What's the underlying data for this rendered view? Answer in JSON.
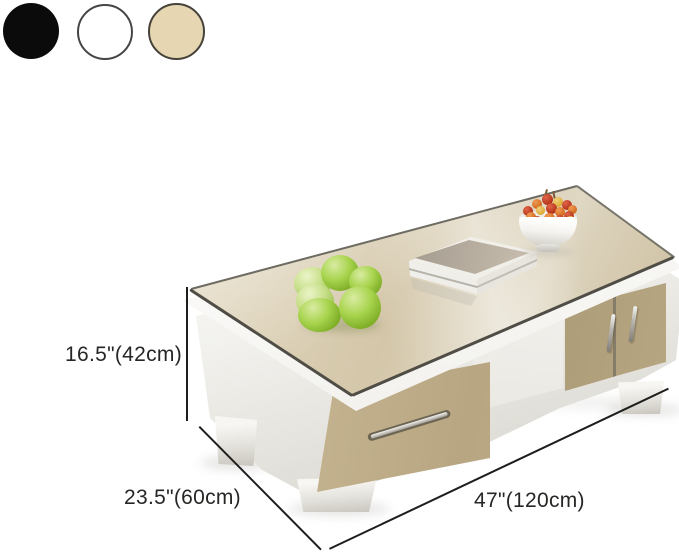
{
  "swatches": {
    "items": [
      {
        "label": "black"
      },
      {
        "label": "white"
      },
      {
        "label": "beige"
      }
    ]
  },
  "dimensions": {
    "height": "16.5\"(42cm)",
    "depth": "23.5\"(60cm)",
    "width": "47\"(120cm)"
  },
  "decor": {
    "items": [
      "green apples",
      "bowl of cherries",
      "magazine stack"
    ]
  },
  "colors": {
    "swatch-black": "#0b0b0b",
    "swatch-white": "#ffffff",
    "swatch-beige": "#e6d6b2",
    "dim-line": "#1d1d1b",
    "glass-champagne": "#d5c8ab",
    "cabinet-champagne": "#c2b18d",
    "body-white": "#f4f3ef",
    "apple-green": "#a8d44e",
    "cherry-red": "#b33317",
    "cherry-orange": "#d26a1e",
    "cherry-yellow": "#ddab37"
  }
}
